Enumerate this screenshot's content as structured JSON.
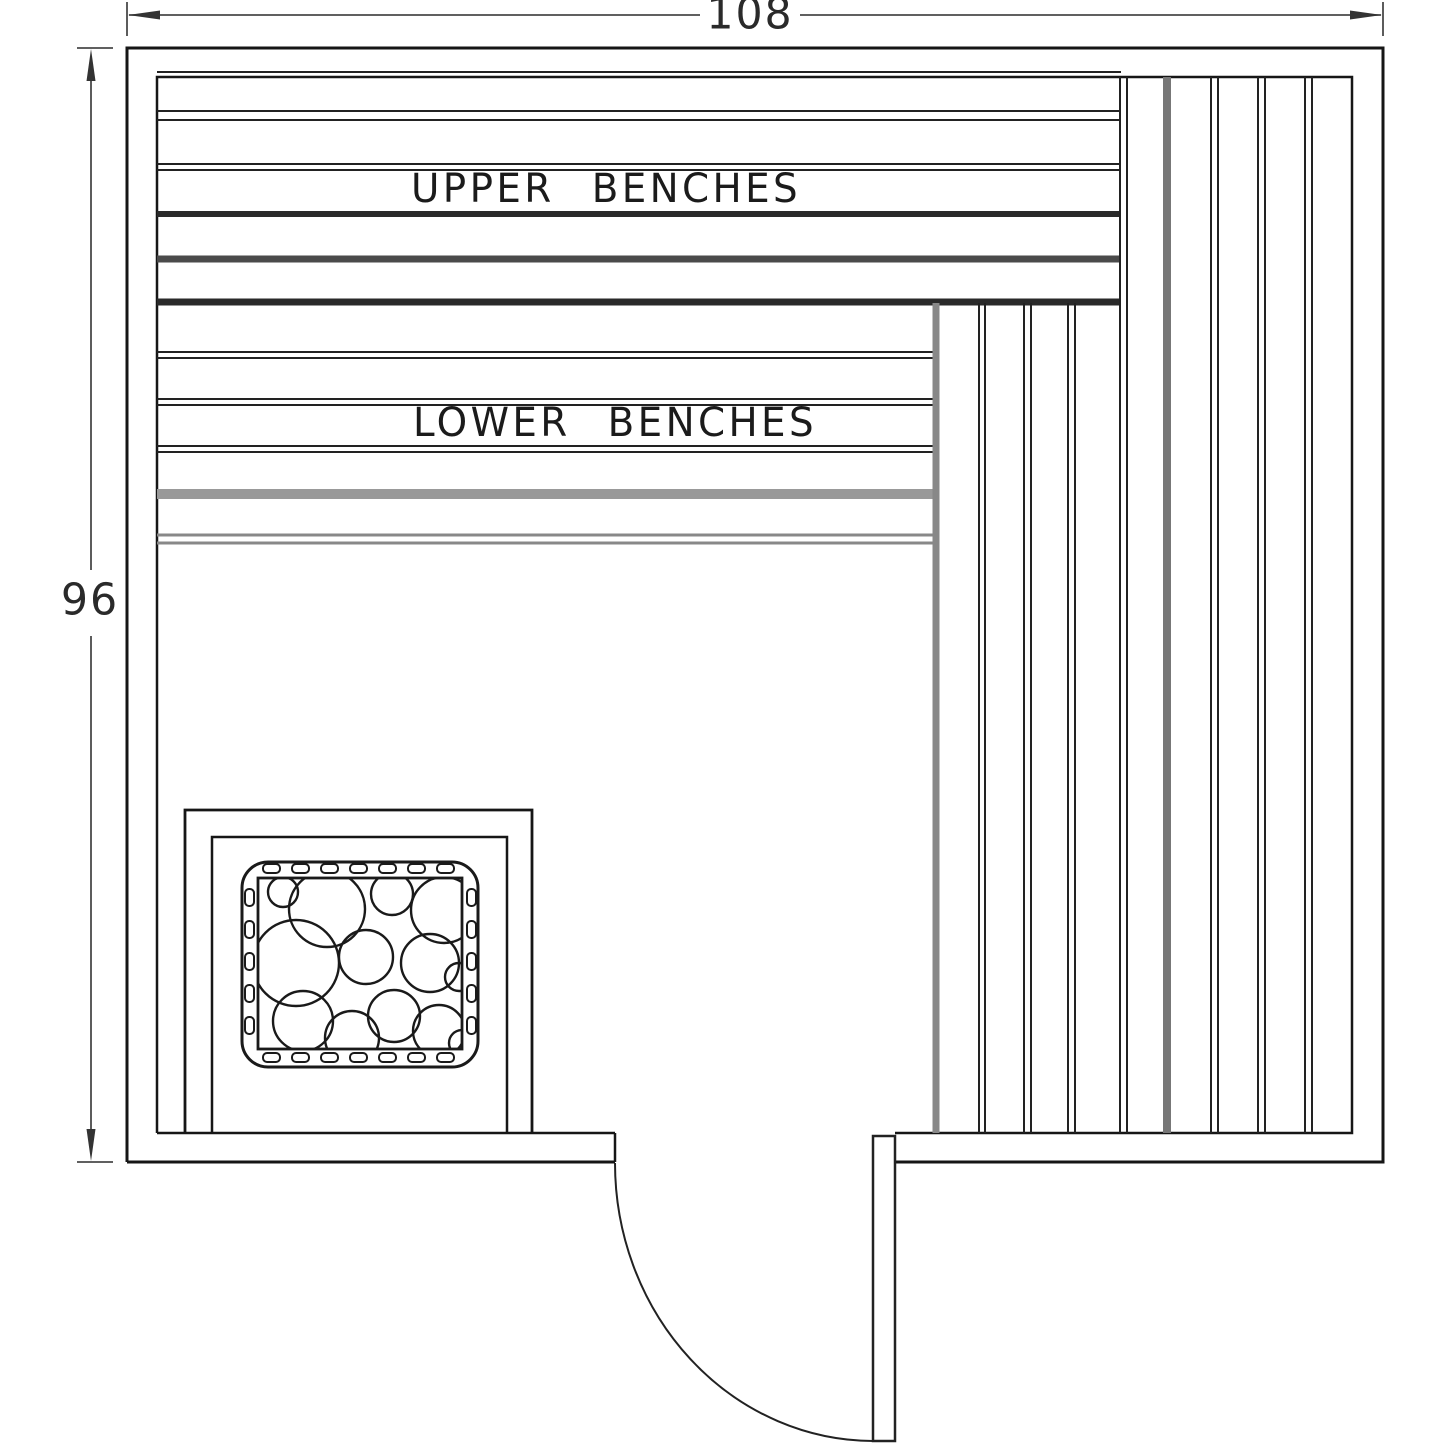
{
  "diagram": {
    "dimension_width": "108",
    "dimension_height": "96",
    "upper_bench_label": "UPPER BENCHES",
    "lower_bench_label": "LOWER BENCHES",
    "colors": {
      "line": "#1a1a1a",
      "dimension": "#4a4a4a",
      "background": "#ffffff"
    }
  }
}
